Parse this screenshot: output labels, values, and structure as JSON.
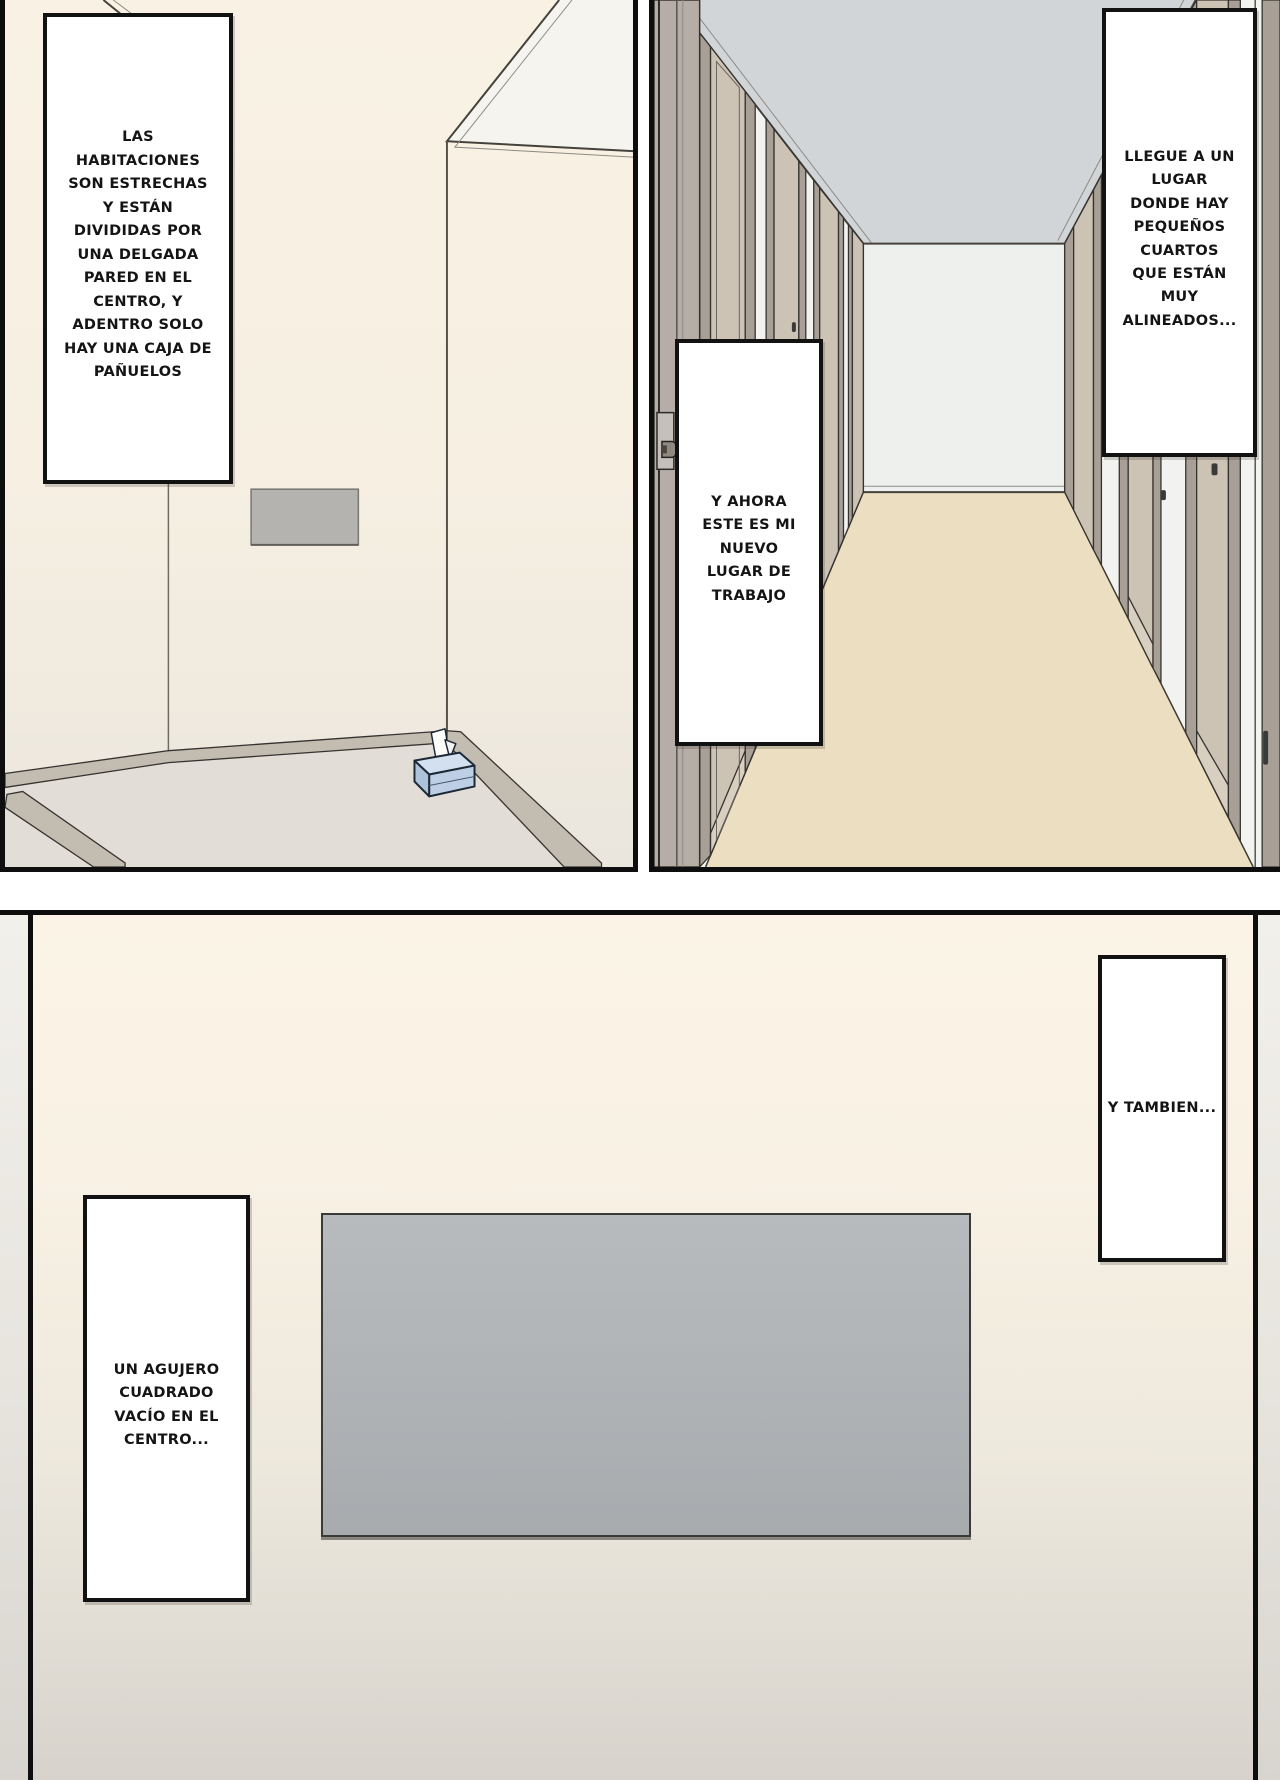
{
  "comic": {
    "panel_top_left": {
      "caption": "LAS\nHABITACIONES\nSON ESTRECHAS\nY ESTÁN\nDIVIDIDAS POR\nUNA DELGADA\nPARED EN EL\nCENTRO, Y\nADENTRO SOLO\nHAY UNA CAJA DE\nPAÑUELOS"
    },
    "panel_top_right": {
      "caption_arrival": "LLEGUE A UN\nLUGAR\nDONDE HAY\nPEQUEÑOS\nCUARTOS\nQUE ESTÁN\nMUY\nALINEADOS...",
      "caption_workplace": "Y AHORA\nESTE ES MI\nNUEVO\nLUGAR DE\nTRABAJO"
    },
    "panel_bottom": {
      "caption_also": "Y TAMBIEN...",
      "caption_hole": "UN AGUJERO\nCUADRADO\nVACÍO EN EL\nCENTRO..."
    }
  },
  "colors": {
    "panel-border": "#0e0e0e",
    "wall-cream": "#f8f1e3",
    "wall-white": "#f2f3f1",
    "ceiling-gray": "#d2d5d7",
    "floor-beige": "#ecdec0",
    "floor-gray": "#e2ded7",
    "hole-gray": "#b0b4b6",
    "door-tan": "#cdc3b5",
    "door-frame": "#a89f96",
    "baseboard": "#c3bcb1",
    "tissue-box-blue": "#c3d4e8"
  }
}
